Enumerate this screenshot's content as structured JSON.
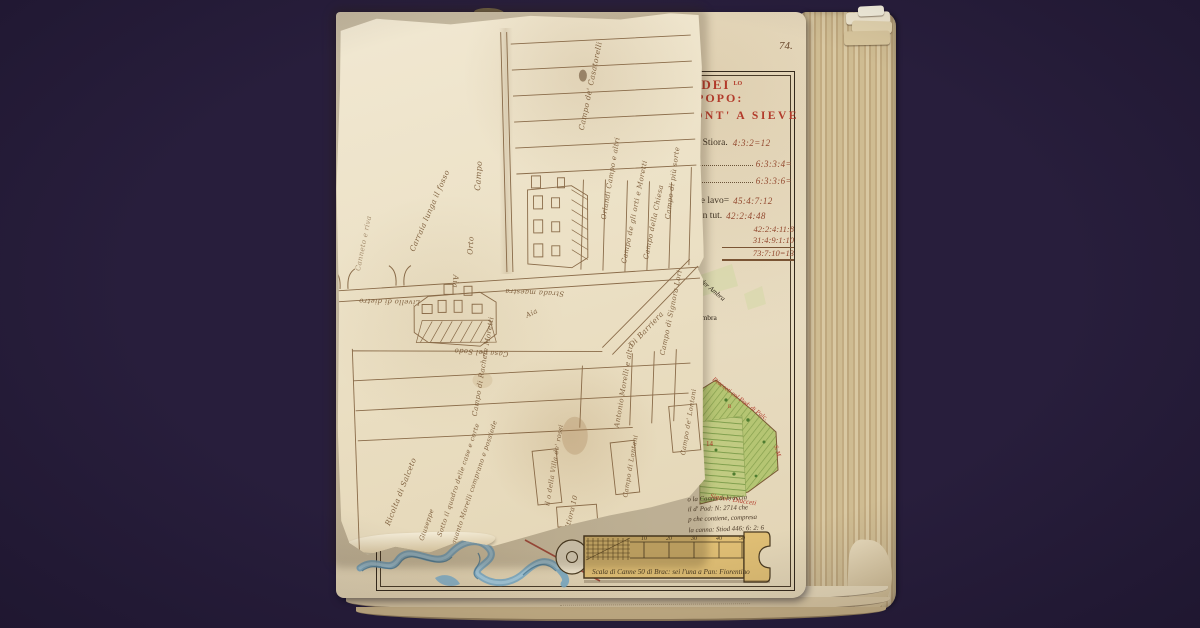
{
  "palette": {
    "background": "#281e3c",
    "paper": "#e9dcc1",
    "ink_brown": "#7a5a38",
    "heading_red": "#b23a2a",
    "map_green": "#aebd6e",
    "river_blue": "#6fa3bf",
    "scale_tan": "#dfbe74"
  },
  "page_number": "74.",
  "base_page": {
    "heading": {
      "line1": "O DEI",
      "sup": "LO",
      "line2": "POPO:",
      "line3": "PONT' A SIEVE"
    },
    "measurements": {
      "rows": [
        {
          "label": "odo Stiora.",
          "value": "4:3:2=12"
        },
        {
          "label": "o",
          "value": "6:3:3:4="
        },
        {
          "label": "",
          "value": "6:3:3:6="
        },
        {
          "label": "parte lavo=",
          "value": "45:4:7:12"
        },
        {
          "label": "ma in tut.",
          "value": "42:2:4:48"
        }
      ],
      "sums": [
        "42:2:4:11:8",
        "31:4:9:1:10",
        "73:7:10=13"
      ]
    },
    "map_labels": {
      "ambra_diag": "der Ambra",
      "ambra": "Ambra",
      "diacceti_top": "Diacceti col Pod: di Palc.",
      "parcel_no": "14",
      "parcel_b": "B",
      "side": "S. M.",
      "diacceti_bottom": "Signor: Diacceti"
    },
    "note_lines": [
      "o la Canna di braccia",
      "il d' Pod: N: 2714 che",
      "p che contiene, compresa",
      "la canna: Stiod 446: 6: 2: 6"
    ],
    "scale": {
      "caption": "Scala di Canne 50 di Brac: sei l'una a Pan: Fiorentino",
      "ticks": [
        "10",
        "20",
        "30",
        "40",
        "50"
      ]
    }
  },
  "fold_map": {
    "labels": [
      "Campo de' Casatorelli",
      "Orlandi Campo e altri",
      "Campo de gli orti e Moretti",
      "Campo di più sorte",
      "Campo della Chiesa",
      "Carraia lunga il fosso",
      "Campo",
      "Orto",
      "Aia",
      "Livello di dietro",
      "Strada maestra",
      "Aia",
      "Casa del Sodo",
      "Campo di Rachele Moretti",
      "Antonio Morelli e altri",
      "Ricolta di Salceto",
      "Sotto il quadro delle case e corte",
      "quanto Morelli comprano e possiede",
      "Giuseppe",
      "il o della Villa de' rossi",
      "Campo di Lontani",
      "Stiora 10",
      "Campo de' Lontani",
      "Di Barriera",
      "Campo di Signora Lori",
      "Canneto e riva"
    ]
  }
}
